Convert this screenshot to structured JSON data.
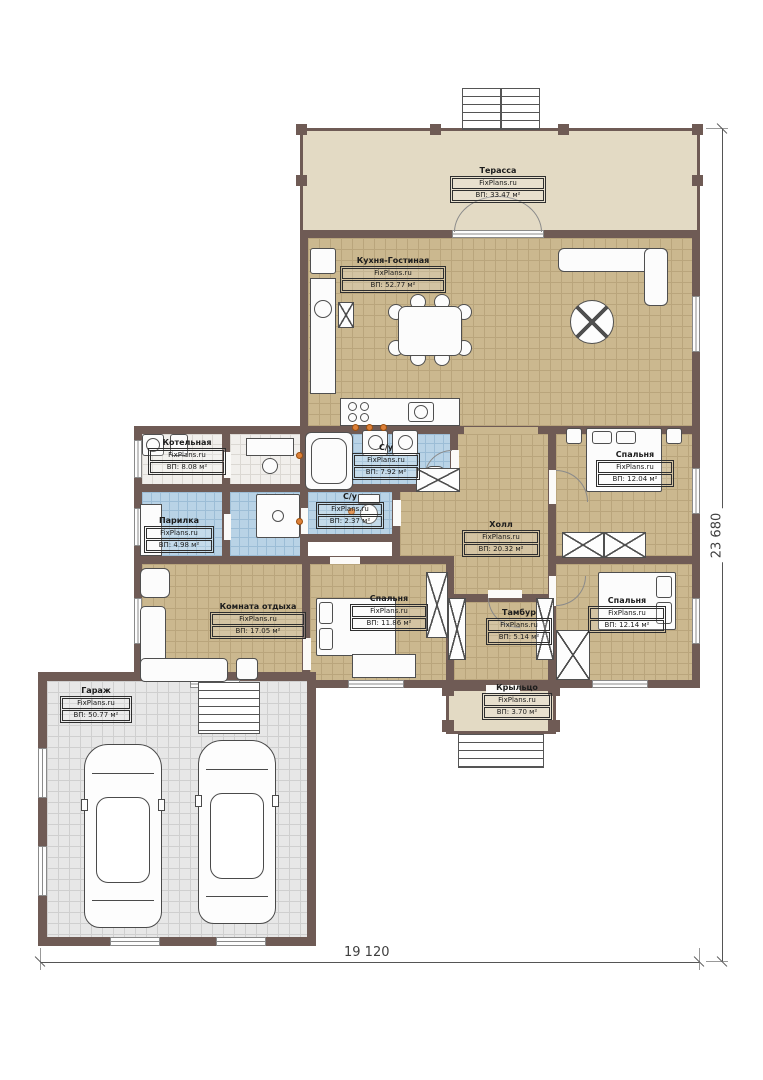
{
  "plan": {
    "title": "floor-plan",
    "wall_color": "#6f5b55",
    "floor_tan": "#cbb88f",
    "floor_blue": "#b9d3e6",
    "floor_gray": "#e7e7e7",
    "terrace_beige": "#e3dac4",
    "accent_dot": "#dd8038"
  },
  "rooms": [
    {
      "name": "Терасса",
      "watermark": "FixPlans.ru",
      "area": "ВП: 33.47 м²"
    },
    {
      "name": "Кухня-Гостиная",
      "watermark": "FixPlans.ru",
      "area": "ВП: 52.77 м²"
    },
    {
      "name": "Котельная",
      "watermark": "FixPlans.ru",
      "area": "ВП: 8.08 м²"
    },
    {
      "name": "Парилка",
      "watermark": "FixPlans.ru",
      "area": "ВП: 4.98 м²"
    },
    {
      "name": "С/у",
      "watermark": "FixPlans.ru",
      "area": "ВП: 7.92 м²"
    },
    {
      "name": "С/у",
      "watermark": "FixPlans.ru",
      "area": "ВП: 2.37 м²"
    },
    {
      "name": "Холл",
      "watermark": "FixPlans.ru",
      "area": "ВП: 20.32 м²"
    },
    {
      "name": "Спальня",
      "watermark": "FixPlans.ru",
      "area": "ВП: 12.04 м²"
    },
    {
      "name": "Спальня",
      "watermark": "FixPlans.ru",
      "area": "ВП: 12.14 м²"
    },
    {
      "name": "Спальня",
      "watermark": "FixPlans.ru",
      "area": "ВП: 11.86 м²"
    },
    {
      "name": "Комната отдыха",
      "watermark": "FixPlans.ru",
      "area": "ВП: 17.05 м²"
    },
    {
      "name": "Тамбур",
      "watermark": "FixPlans.ru",
      "area": "ВП: 5.14 м²"
    },
    {
      "name": "Крыльцо",
      "watermark": "FixPlans.ru",
      "area": "ВП: 3.70 м²"
    },
    {
      "name": "Гараж",
      "watermark": "FixPlans.ru",
      "area": "ВП: 50.77 м²"
    }
  ],
  "dimensions": {
    "width_label": "19 120",
    "height_label": "23 680"
  }
}
